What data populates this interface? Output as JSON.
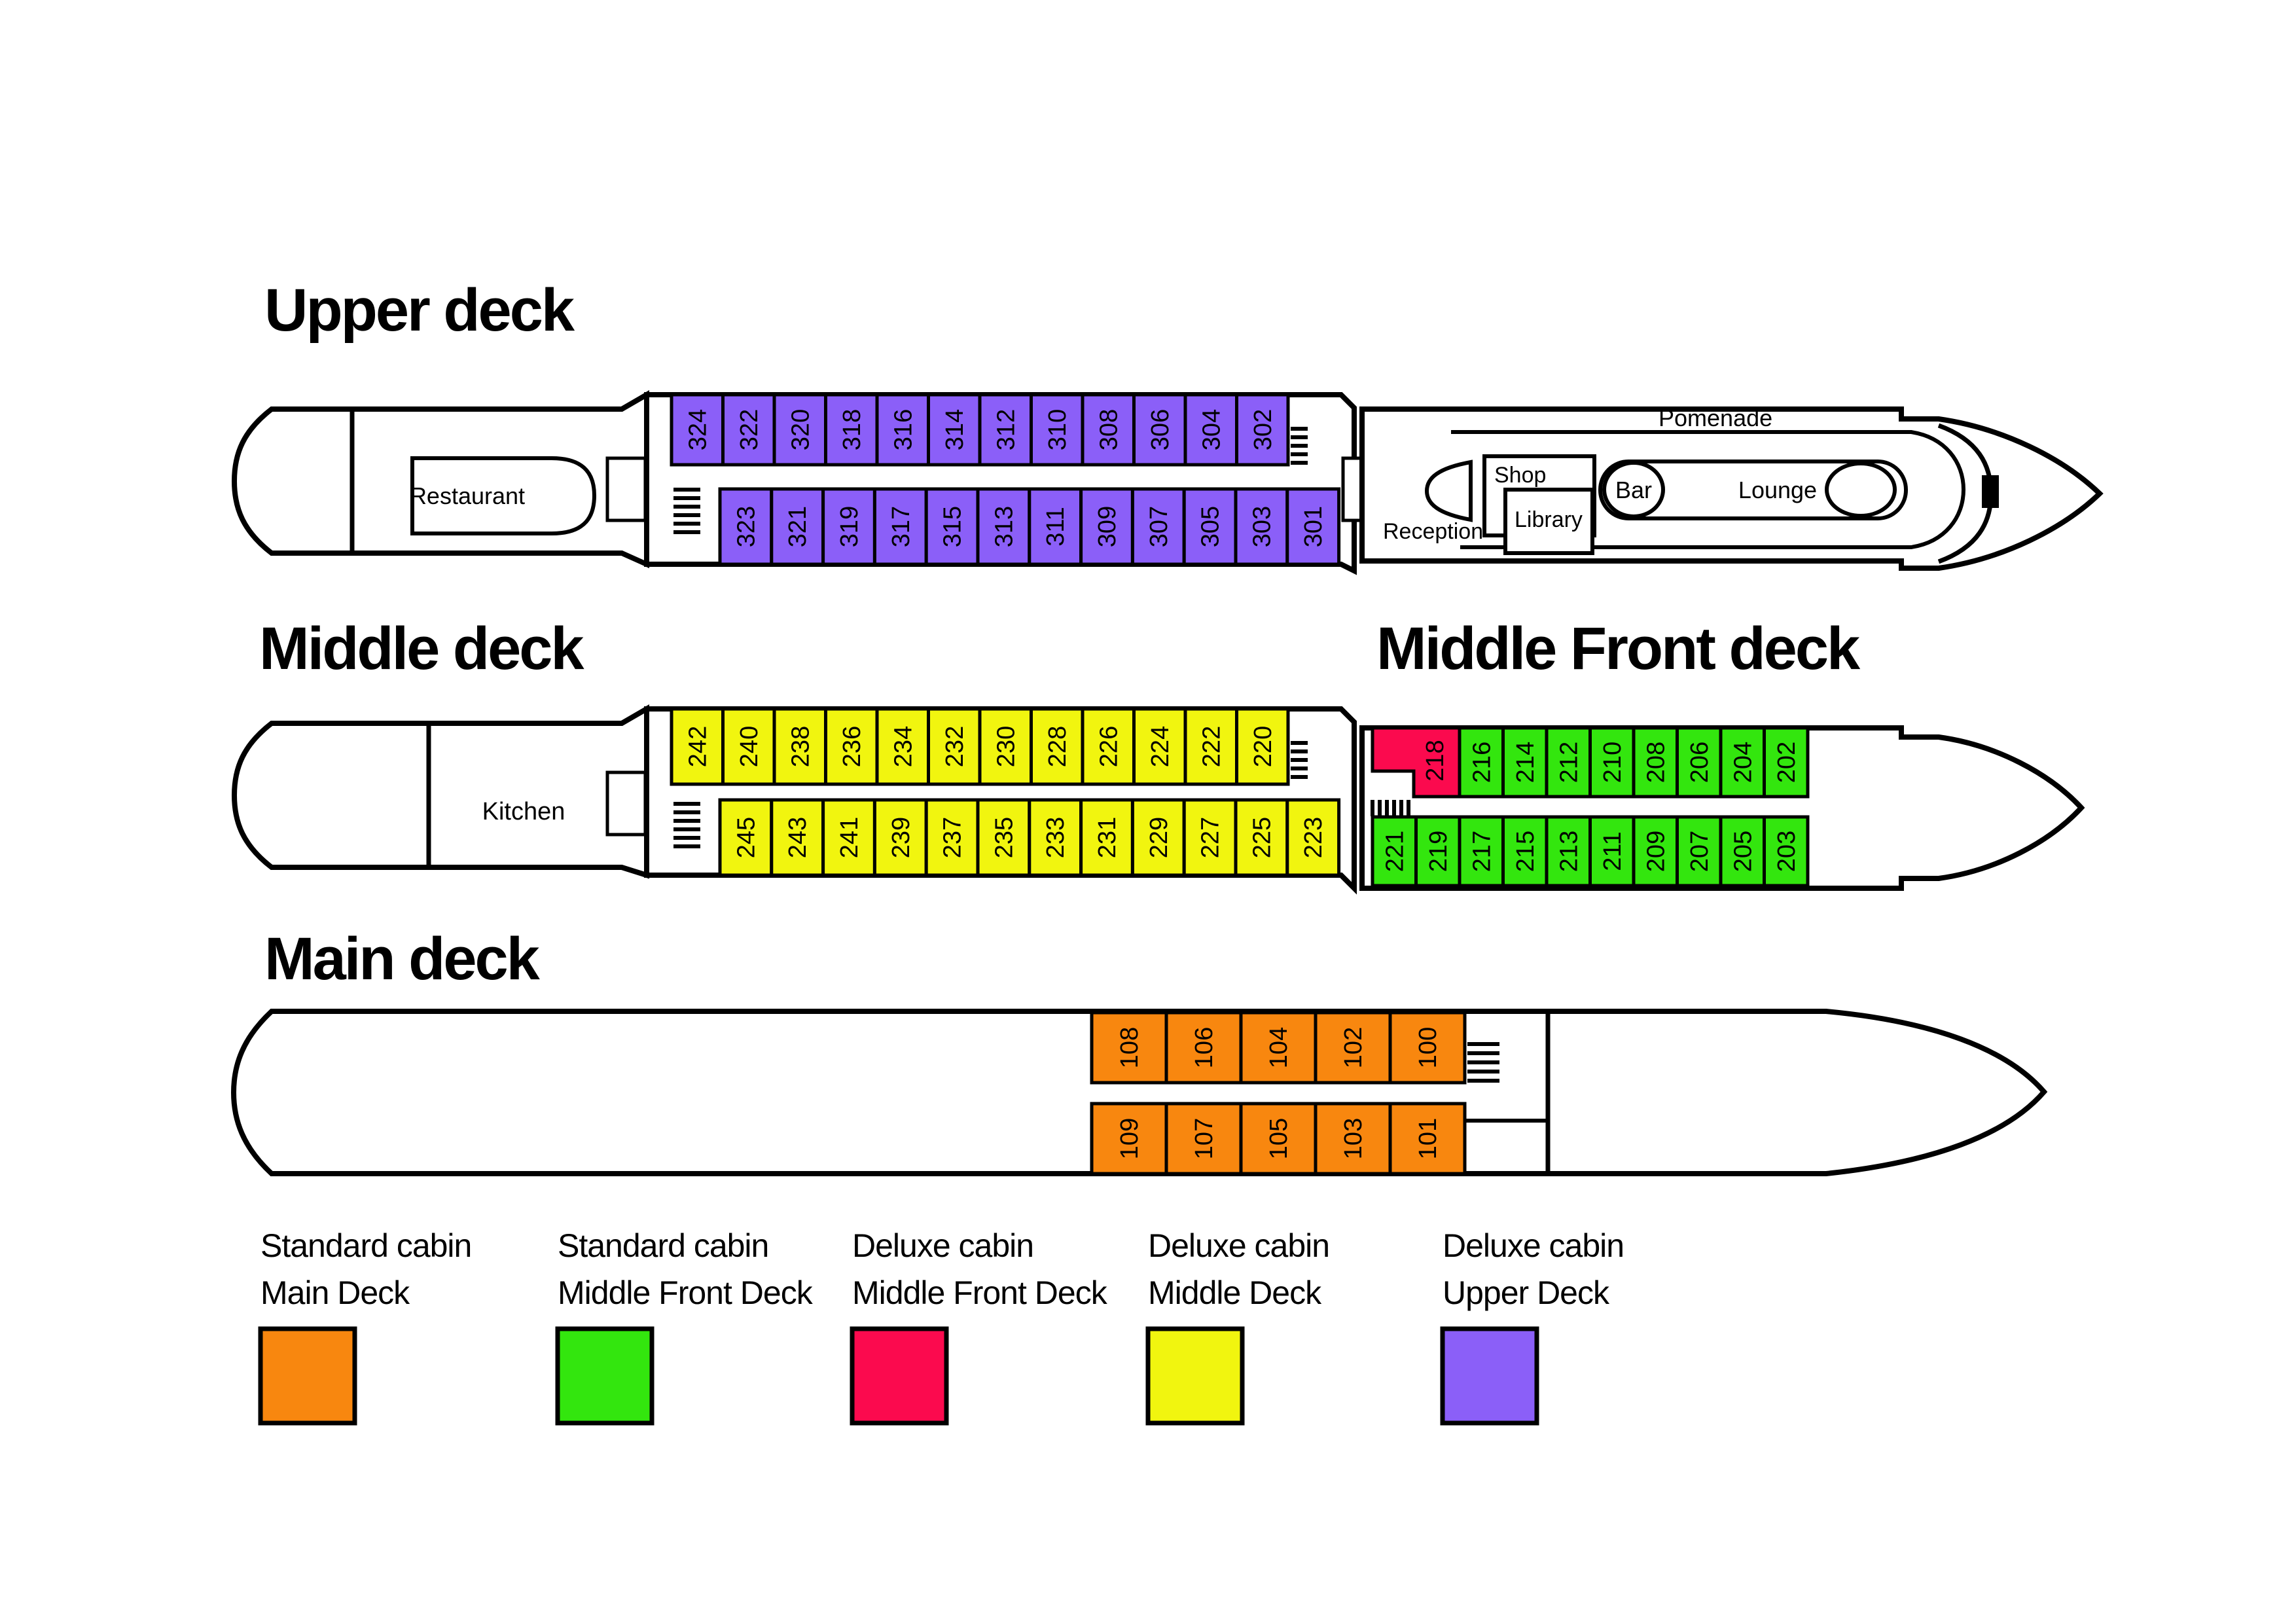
{
  "decks": {
    "upper": {
      "title": "Upper deck",
      "cabins_top": [
        "324",
        "322",
        "320",
        "318",
        "316",
        "314",
        "312",
        "310",
        "308",
        "306",
        "304",
        "302"
      ],
      "cabins_bottom": [
        "323",
        "321",
        "319",
        "317",
        "315",
        "313",
        "311",
        "309",
        "307",
        "305",
        "303",
        "301"
      ],
      "labels": {
        "restaurant": "Restaurant",
        "reception": "Reception",
        "shop": "Shop",
        "library": "Library",
        "bar": "Bar",
        "lounge": "Lounge",
        "promenade": "Pomenade"
      }
    },
    "middle": {
      "title": "Middle deck",
      "cabins_top": [
        "242",
        "240",
        "238",
        "236",
        "234",
        "232",
        "230",
        "228",
        "226",
        "224",
        "222",
        "220"
      ],
      "cabins_bottom": [
        "245",
        "243",
        "241",
        "239",
        "237",
        "235",
        "233",
        "231",
        "229",
        "227",
        "225",
        "223"
      ],
      "labels": {
        "kitchen": "Kitchen"
      }
    },
    "middle_front": {
      "title": "Middle Front deck",
      "cabins_top": [
        "218",
        "216",
        "214",
        "212",
        "210",
        "208",
        "206",
        "204",
        "202"
      ],
      "cabins_bottom": [
        "221",
        "219",
        "217",
        "215",
        "213",
        "211",
        "209",
        "207",
        "205",
        "203"
      ]
    },
    "main": {
      "title": "Main deck",
      "cabins_top": [
        "108",
        "106",
        "104",
        "102",
        "100"
      ],
      "cabins_bottom": [
        "109",
        "107",
        "105",
        "103",
        "101"
      ]
    }
  },
  "colors": {
    "standard_main": "#F8870F",
    "standard_middle_front": "#33E60E",
    "deluxe_middle_front": "#FB0A4E",
    "deluxe_middle": "#F1F50F",
    "deluxe_upper": "#8B5FF8",
    "outline": "#000000"
  },
  "legend": [
    {
      "line1": "Standard cabin",
      "line2": "Main Deck",
      "color": "#F8870F"
    },
    {
      "line1": "Standard cabin",
      "line2": "Middle Front Deck",
      "color": "#33E60E"
    },
    {
      "line1": "Deluxe cabin",
      "line2": "Middle Front Deck",
      "color": "#FB0A4E"
    },
    {
      "line1": "Deluxe cabin",
      "line2": "Middle Deck",
      "color": "#F1F50F"
    },
    {
      "line1": "Deluxe cabin",
      "line2": "Upper Deck",
      "color": "#8B5FF8"
    }
  ]
}
